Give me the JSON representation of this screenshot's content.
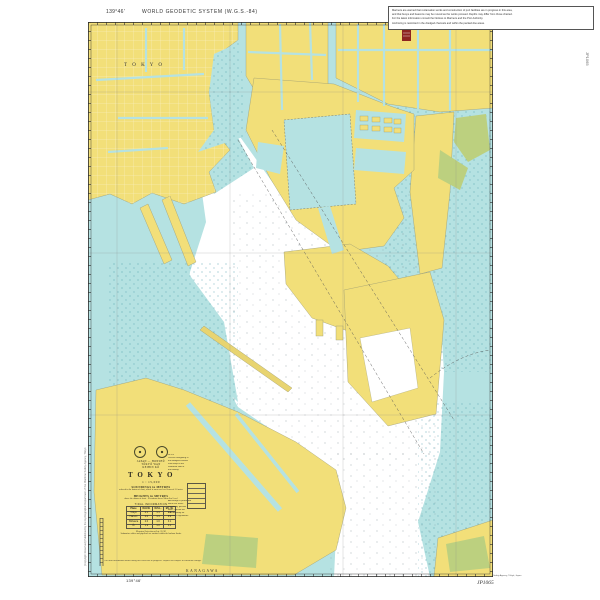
{
  "colors": {
    "land": "#f2df79",
    "shallow_water": "#b5e2e2",
    "deep_water": "#ffffff",
    "vegetation": "#bcd07f",
    "frame": "#2b2b2b",
    "hazard_red": "#8e2420",
    "stipple": "#3f94a4"
  },
  "margins": {
    "top_left_longitude": "139°46'",
    "geodetic_note": "WORLD GEODETIC SYSTEM (W.G.S.-84)",
    "top_right_note_lines": [
      "Mariners are warned that reclamation works and construction of port facilities are in progress in this area,",
      "and that buoys and beacons may be moved as the works proceed. Depths may differ from those charted.",
      "For the latest information consult the Notices to Mariners and the Port Authority.",
      "Anchoring is restricted in the dredged channels and within the pecked-line areas."
    ],
    "right_vertical_label": "JP1065",
    "left_vertical_note": "(Copyright Reserved)   Published by the Hydrographic Department of the Maritime Safety Agency, Tōkyō",
    "bottom_print_note": "Compiled and printed by the Hydrographic Department, Maritime Safety Agency, Tōkyō, Japan",
    "bottom_chart_number": "JP1065",
    "bottom_left_longitude": "139°46'"
  },
  "chart_labels": {
    "city": "T O K Y O",
    "prefecture": "KANAGAWA"
  },
  "chart_notes": {
    "south_note": "The land reclamation works along this coast are in progress. Depths are subject to continual change."
  },
  "title_block": {
    "nation": "JAPAN — HONSHŪ",
    "region": "TŌKYŌ WAN",
    "port": "KEIHIN KŌ",
    "title": "T O K Y O",
    "scale": "1 : 15,000",
    "soundings_heading": "SOUNDINGS in METRES",
    "soundings_note": "reduced to the datum of chart, which is mean sea level lowered 1.0 metre",
    "heights_heading": "HEIGHTS in METRES",
    "heights_note": "above the datum of chart · Elevations above Mean Sea Level",
    "projection_note": "Mercator Projection at Lat. 35°38′",
    "table": {
      "caption": "TIDAL INFORMATION",
      "headers": [
        "Place",
        "M.H.W.",
        "M.S.L.",
        "M.L.W."
      ],
      "rows": [
        [
          "Tōkyō",
          "2.1",
          "1.1",
          "0.2"
        ],
        [
          "Harumi",
          "2.0",
          "1.1",
          "0.2"
        ],
        [
          "Shibaura",
          "2.0",
          "1.0",
          "0.1"
        ],
        [
          "Ōi",
          "1.9",
          "1.0",
          "0.1"
        ]
      ]
    },
    "side_notes_top": [
      "NOTE",
      "Vessels navigating in",
      "the dredged channel",
      "shall keep to the",
      "starboard side of",
      "the fairway."
    ],
    "side_notes_bottom": [
      "Anchorage is prohibited",
      "within the areas",
      "marked by pecked",
      "lines. Consult the",
      "Port Authority for",
      "the latest regulations."
    ],
    "bottom_note": "Submarine cables and pipelines are omitted within the harbour limits."
  }
}
